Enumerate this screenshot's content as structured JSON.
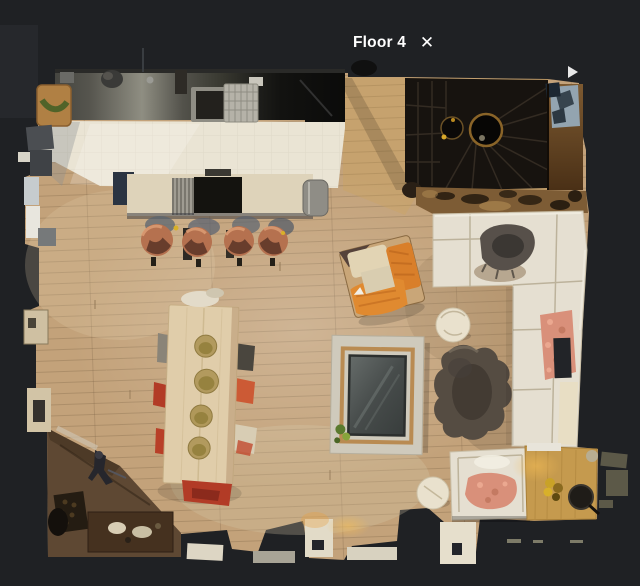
{
  "header": {
    "title": "Floor 4",
    "close_icon": "✕"
  },
  "floorplan": {
    "floor_label": "Floor 4",
    "view": "top-down floor plan scan",
    "elements": [
      "kitchen-counter",
      "kitchen-sink",
      "dish-rack",
      "cutting-board",
      "kitchen-island",
      "bar-stools",
      "spiral-stairwell",
      "stair-wood-wall",
      "sectional-sofa",
      "fur-throw",
      "salmon-blanket",
      "fur-rug",
      "glass-fire-table",
      "dining-table",
      "dining-chairs",
      "orange-armchair",
      "white-armchair",
      "coffee-table",
      "round-pouf",
      "round-stool",
      "bench",
      "doormat"
    ],
    "colors": {
      "background": "#1f2124",
      "wood_floor": "#c3a27a",
      "wood_floor_dark": "#5e4833",
      "kitchen_tile": "#eae4d4",
      "counter_dark": "#2e2e2a",
      "island_top": "#ded3ba",
      "stool_copper": "#b5714f",
      "stairwell": "#17130f",
      "stair_wood_wall": "#6e4c2a",
      "sofa_white": "#e5dfd1",
      "salmon_throw": "#d9907a",
      "fur_throw": "#57504a",
      "fur_rug": "#554c42",
      "fire_surround": "#cfcabc",
      "glass_panel": "#4b504f",
      "dining_table": "#e0cdaa",
      "coffee_table": "#c59a4e",
      "chair_red": "#b23b26",
      "armchair_orange": "#d97f2a",
      "pouf_cream": "#e9e1cd",
      "bench_wood": "#45311f"
    }
  }
}
